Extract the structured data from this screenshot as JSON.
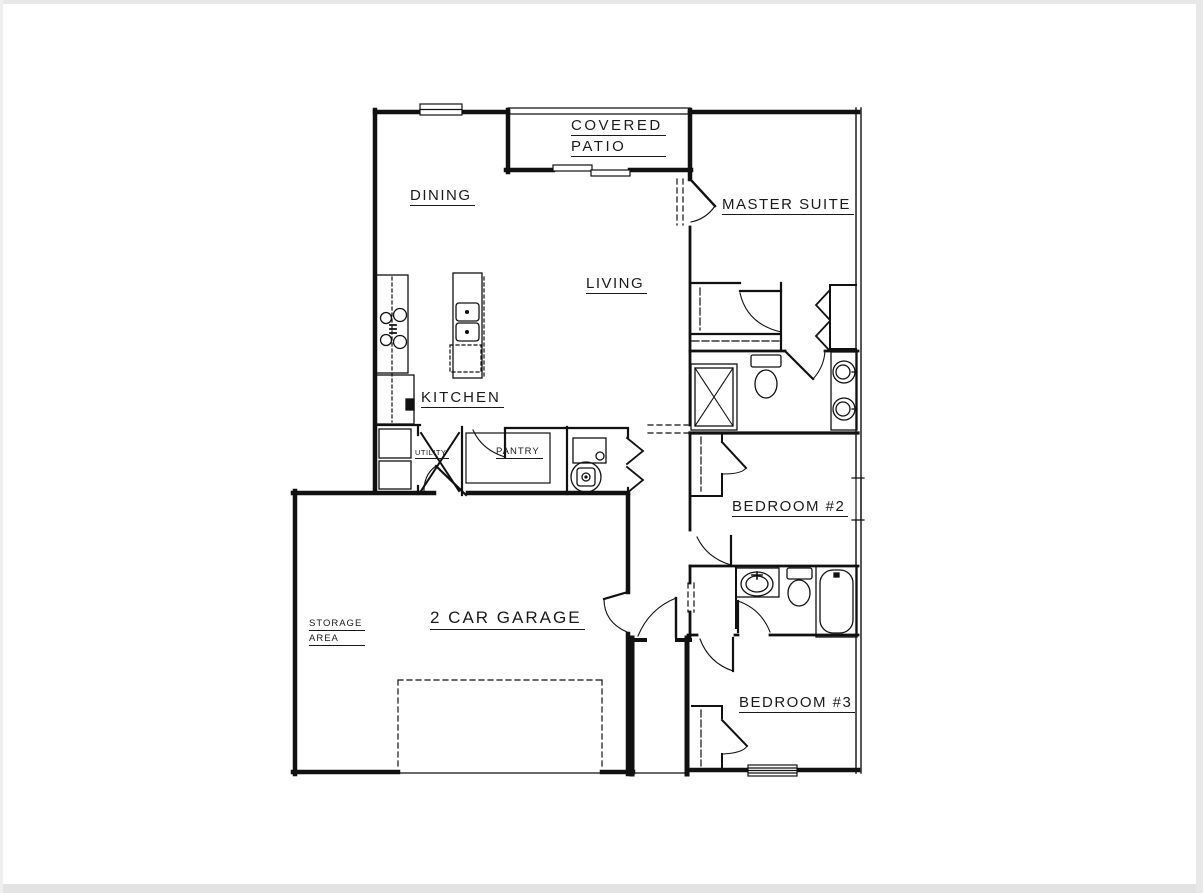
{
  "page": {
    "background": "#ffffff",
    "edge_shade": "#e8e8e8",
    "line_color": "#111111",
    "label_color": "#1a1a1a"
  },
  "labels": {
    "covered_patio_line1": "COVERED",
    "covered_patio_line2": "PATIO",
    "dining": "DINING",
    "master_suite": "MASTER SUITE",
    "living": "LIVING",
    "kitchen": "KITCHEN",
    "utility": "UTILITY",
    "pantry": "PANTRY",
    "bedroom_2": "BEDROOM #2",
    "garage": "2 CAR GARAGE",
    "storage_line1": "STORAGE",
    "storage_line2": "AREA",
    "bedroom_3": "BEDROOM #3"
  },
  "fixtures": [
    "cooktop",
    "refrigerator",
    "kitchen-island-sink",
    "dishwasher",
    "washer",
    "dryer",
    "pantry-shelves",
    "furnace",
    "water-heater",
    "shower",
    "toilet",
    "double-vanity-sinks",
    "vanity-sink",
    "bathtub",
    "sliding-patio-door",
    "garage-overhead-door",
    "window",
    "door-swing",
    "bifold-closet-doors"
  ]
}
